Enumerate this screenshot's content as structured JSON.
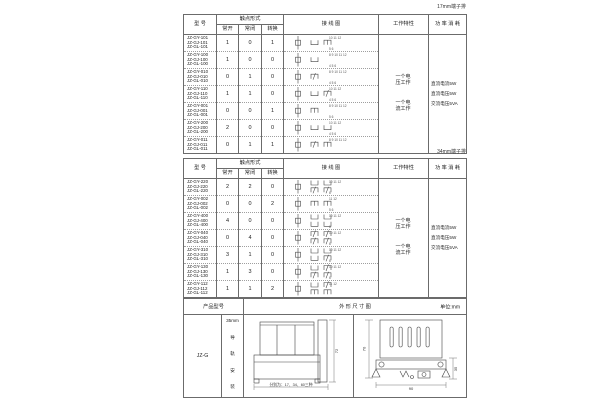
{
  "labels": {
    "t17": "17mm端子排",
    "t34": "34mm端子排"
  },
  "headers": {
    "model": "型 号",
    "contact_form": "触点形式",
    "no": "常开",
    "nc": "常闭",
    "co": "转换",
    "wiring": "接 线 图",
    "characteristic": "工作特性",
    "power": "功 率 消 耗"
  },
  "shared": {
    "characteristics": [
      "一个电压工作",
      "一个电流工作"
    ],
    "power_lines": [
      "直流电流5W",
      "直流电压5W",
      "交流电压5VA"
    ]
  },
  "table17": {
    "rows": [
      {
        "models": [
          "JZ-GY-101",
          "JZ-GJ-101",
          "JZ-GL-101"
        ],
        "no": 1,
        "nc": 0,
        "co": 1,
        "diagram": {
          "top": "10 11 12",
          "bottom": "5 6"
        }
      },
      {
        "models": [
          "JZ-GY-100",
          "JZ-GJ-100",
          "JZ-GL-100"
        ],
        "no": 1,
        "nc": 0,
        "co": 0,
        "diagram": {
          "top": "8 9 10 11 12",
          "bottom": "4 5 6"
        }
      },
      {
        "models": [
          "JZ-GY-010",
          "JZ-GJ-010",
          "JZ-GL-010"
        ],
        "no": 0,
        "nc": 1,
        "co": 0,
        "diagram": {
          "top": "8 9 10 11 12",
          "bottom": "4 5 6"
        }
      },
      {
        "models": [
          "JZ-GY-110",
          "JZ-GJ-110",
          "JZ-GL-110"
        ],
        "no": 1,
        "nc": 1,
        "co": 0,
        "diagram": {
          "top": "10 11 12",
          "bottom": "4 5 6"
        }
      },
      {
        "models": [
          "JZ-GY-001",
          "JZ-GJ-001",
          "JZ-GL-001"
        ],
        "no": 0,
        "nc": 0,
        "co": 1,
        "diagram": {
          "top": "8 9 10 11 12",
          "bottom": "5 6"
        }
      },
      {
        "models": [
          "JZ-GY-200",
          "JZ-GJ-200",
          "JZ-GL-200"
        ],
        "no": 2,
        "nc": 0,
        "co": 0,
        "diagram": {
          "top": "10 11 12",
          "bottom": "4 5 6"
        }
      },
      {
        "models": [
          "JZ-GY-011",
          "JZ-GJ-011",
          "JZ-GL-011"
        ],
        "no": 0,
        "nc": 1,
        "co": 1,
        "diagram": {
          "top": "8 9 10 11 12",
          "bottom": ""
        }
      }
    ]
  },
  "table34": {
    "rows": [
      {
        "models": [
          "JZ-GY-220",
          "JZ-GJ-220",
          "JZ-GL-220"
        ],
        "no": 2,
        "nc": 2,
        "co": 0,
        "diagram": {
          "top": "10 11 12",
          "bottom": "6"
        }
      },
      {
        "models": [
          "JZ-GY-002",
          "JZ-GJ-002",
          "JZ-GL-002"
        ],
        "no": 0,
        "nc": 0,
        "co": 2,
        "diagram": {
          "top": "11 12",
          "bottom": "5 6"
        }
      },
      {
        "models": [
          "JZ-GY-400",
          "JZ-GJ-400",
          "JZ-GL-400"
        ],
        "no": 4,
        "nc": 0,
        "co": 0,
        "diagram": {
          "top": "10 11 12",
          "bottom": "6"
        }
      },
      {
        "models": [
          "JZ-GY-040",
          "JZ-GJ-040",
          "JZ-GL-040"
        ],
        "no": 0,
        "nc": 4,
        "co": 0,
        "diagram": {
          "top": "10 11 12",
          "bottom": "6"
        }
      },
      {
        "models": [
          "JZ-GY-310",
          "JZ-GJ-310",
          "JZ-GL-310"
        ],
        "no": 3,
        "nc": 1,
        "co": 0,
        "diagram": {
          "top": "10 11 12",
          "bottom": "6"
        }
      },
      {
        "models": [
          "JZ-GY-130",
          "JZ-GJ-130",
          "JZ-GL-130"
        ],
        "no": 1,
        "nc": 3,
        "co": 0,
        "diagram": {
          "top": "10 11 12",
          "bottom": "6"
        }
      },
      {
        "models": [
          "JZ-GY-112",
          "JZ-GJ-112",
          "JZ-GL-112"
        ],
        "no": 1,
        "nc": 1,
        "co": 2,
        "diagram": {
          "top": "11 12",
          "bottom": ""
        }
      }
    ]
  },
  "outline": {
    "product_model_header": "产品型号",
    "drawing_header": "外 形 尺 寸 图",
    "unit": "单位:mm",
    "model": "JZ-G",
    "mount_size": "35mm",
    "mount_text": [
      "导",
      "轨",
      "安",
      "装"
    ],
    "front": {
      "height_dim": "72",
      "width_note": "分别为：17、34、60三种"
    },
    "side": {
      "height_dim": "70",
      "width_dim": "90",
      "rail_dim": "35"
    }
  }
}
